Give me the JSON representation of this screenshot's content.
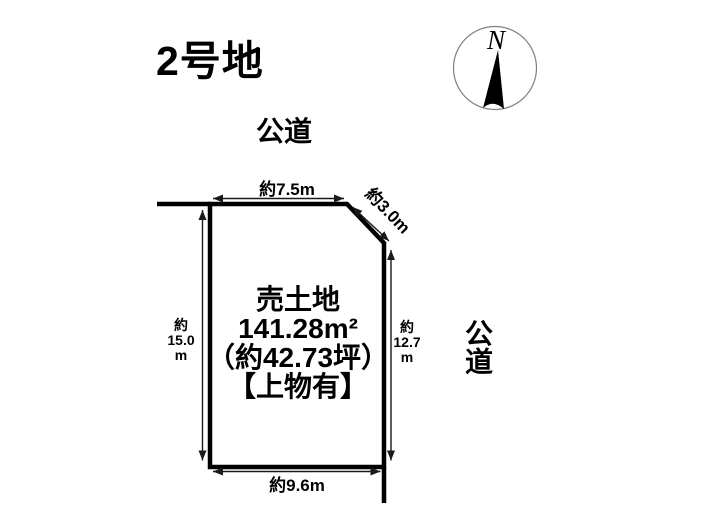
{
  "title": "2号地",
  "compass": {
    "north_label": "N"
  },
  "roads": {
    "top_label": "公道",
    "right_label": "公道"
  },
  "plot": {
    "label": {
      "type": "売土地",
      "area_m2": "141.28m²",
      "area_tsubo": "（約42.73坪）",
      "note": "【上物有】"
    },
    "dimensions": {
      "top": "約7.5m",
      "diagonal": "約3.0m",
      "bottom": "約9.6m",
      "left": {
        "prefix": "約",
        "value": "15.0",
        "unit": "m"
      },
      "right": {
        "prefix": "約",
        "value": "12.7",
        "unit": "m"
      }
    }
  },
  "colors": {
    "background": "#ffffff",
    "boundary_line": "#000000",
    "dimension_line": "#1a1a1a",
    "text": "#000000",
    "compass_ring": "#808080",
    "compass_needle": "#000000"
  }
}
